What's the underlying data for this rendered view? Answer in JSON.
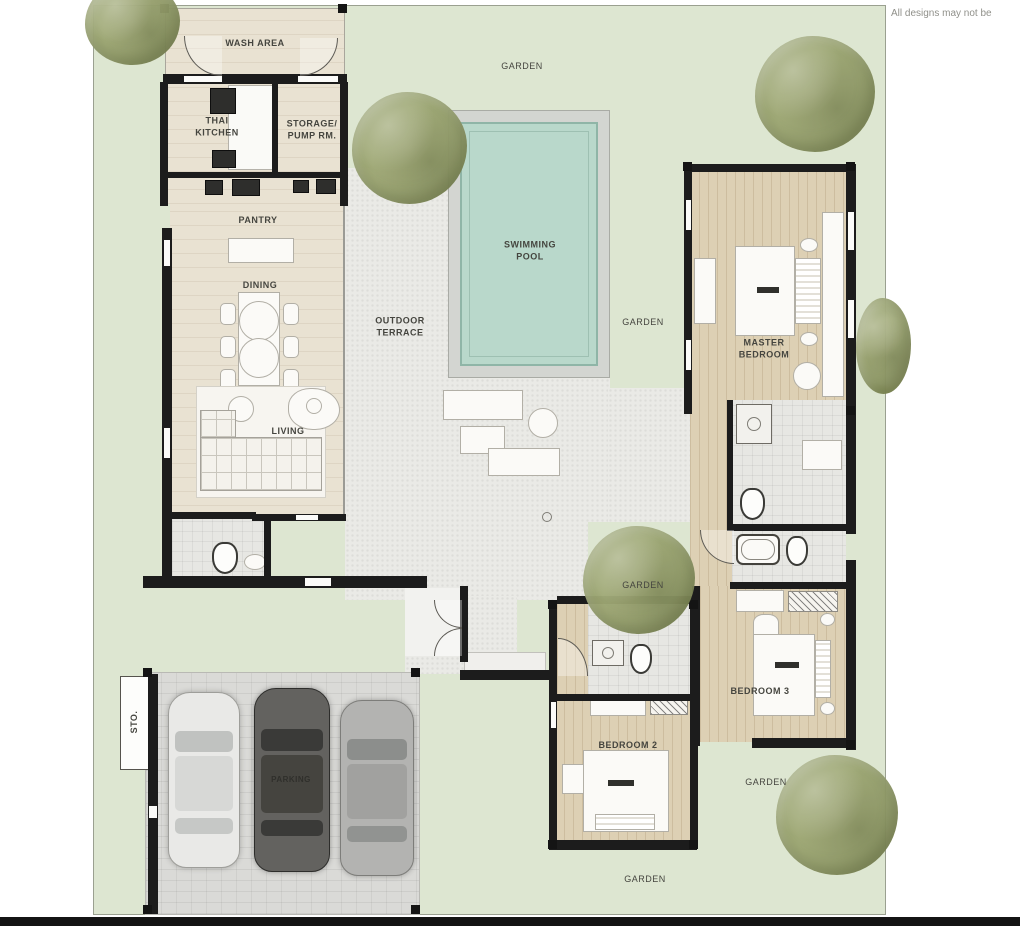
{
  "disclaimer": "All designs may not be",
  "rooms": {
    "wash_area": "WASH AREA",
    "thai_kitchen": "THAI KITCHEN",
    "storage_pump_rm": "STORAGE/ PUMP RM.",
    "pantry": "PANTRY",
    "dining": "DINING",
    "living": "LIVING",
    "swimming_pool": "SWIMMING POOL",
    "outdoor_terrace": "OUTDOOR TERRACE",
    "master_bedroom": "MASTER BEDROOM",
    "bedroom_2": "BEDROOM 2",
    "bedroom_3": "BEDROOM 3",
    "parking": "PARKING",
    "sto": "STO."
  },
  "garden_labels": [
    "GARDEN",
    "GARDEN",
    "GARDEN",
    "GARDEN",
    "GARDEN"
  ],
  "site": {
    "cars_in_garage": 3,
    "bedrooms": 3,
    "pool": true
  },
  "colors": {
    "garden": "#dde6d1",
    "garden_border": "#9aa090",
    "tree": "#9aa471",
    "pool_water": "#b9d8cb",
    "pool_deck": "#d3d5d1",
    "terrace": "#eaeae6",
    "stone_floor": "#e9e2d2",
    "wood_floor": "#ddd0b4",
    "tile_floor": "#e7e7e3",
    "garage_floor": "#dadad7",
    "wall": "#1c1c1c",
    "label_text": "#45453f",
    "page_bg": "#ffffff"
  }
}
